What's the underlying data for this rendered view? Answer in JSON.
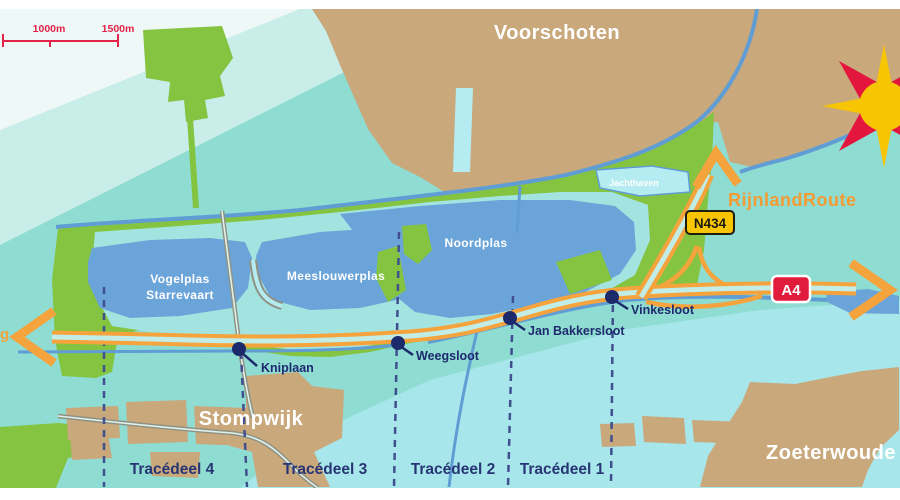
{
  "map": {
    "scale": {
      "tick_1000": "1000m",
      "tick_1500": "1500m"
    },
    "towns": {
      "voorschoten": "Voorschoten",
      "stompwijk": "Stompwijk",
      "zoeterwoude": "Zoeterwoude"
    },
    "water": {
      "vogelplas_line1": "Vogelplas",
      "vogelplas_line2": "Starrevaart",
      "meeslouwerplas": "Meeslouwerplas",
      "noordplas": "Noordplas",
      "jachthaven": "Jachthaven"
    },
    "route": {
      "name": "RijnlandRoute",
      "n434": "N434",
      "a4": "A4",
      "edge_fragment": "g"
    },
    "waypoints": [
      {
        "label": "Kniplaan"
      },
      {
        "label": "Weegsloot"
      },
      {
        "label": "Jan Bakkersloot"
      },
      {
        "label": "Vinkesloot"
      }
    ],
    "sections": [
      {
        "label": "Tracédeel 4"
      },
      {
        "label": "Tracédeel 3"
      },
      {
        "label": "Tracédeel 2"
      },
      {
        "label": "Tracédeel 1"
      }
    ],
    "colors": {
      "water_teal": "#8edcd2",
      "land_green": "#85c441",
      "built_tan": "#c9a87c",
      "lake_blue": "#6ba4d9",
      "route_orange": "#f5a33c",
      "accent_red": "#e3173e",
      "badge_yellow": "#f8c504",
      "label_navy": "#1e2a6d"
    }
  }
}
